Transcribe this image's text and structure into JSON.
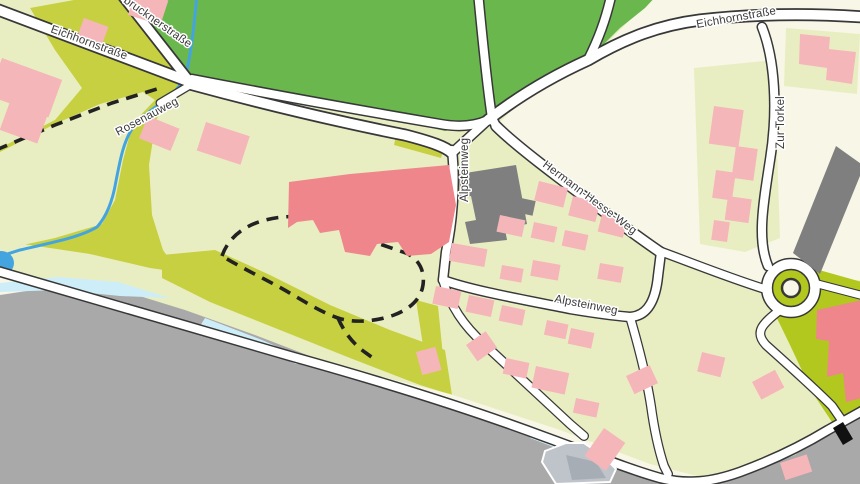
{
  "map": {
    "title": "Street map with lakeshore",
    "street_labels": {
      "eichhornstrasse_west": "Eichhornstraße",
      "brucknerstrasse_partial": "brucknerstraße",
      "rosenauweg": "Rosenauweg",
      "alpsteinweg_north": "Alpsteinweg",
      "hermann_hesse_weg": "Hermann-Hesse-Weg",
      "alpsteinweg_east": "Alpsteinweg",
      "eichhornstrasse_east": "Eichhornstraße",
      "zur_torkel": "Zur Torkel"
    },
    "colors": {
      "base": "#e9eec2",
      "cream": "#f8f6e6",
      "olive": "#c6d040",
      "lime": "#b2c81e",
      "park": "#6ab84d",
      "water": "#a9a9a9",
      "shore_cyan": "#cdeef8",
      "stream": "#44a4e0",
      "road_fill": "#ffffff",
      "road_casing": "#383838",
      "building_pink": "#f5b6ba",
      "building_red": "#ee868b",
      "building_gray": "#7f7f7f",
      "pier": "#bfc4ca",
      "pier_inner": "#a6adb5",
      "trail": "#222222",
      "label": "#3a3a3a",
      "halo": "#ffffff"
    }
  }
}
